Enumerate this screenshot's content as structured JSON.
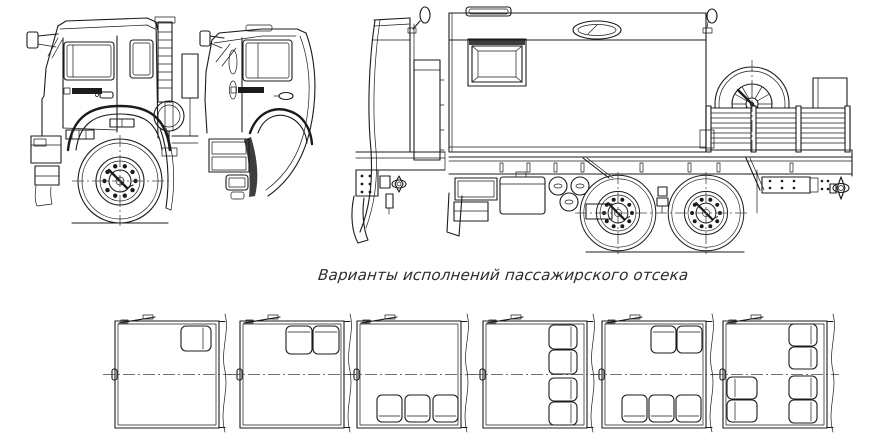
{
  "canvas": {
    "width": 883,
    "height": 442,
    "background": "#ffffff",
    "line_color": "#1b1b1b"
  },
  "caption": {
    "text": "Варианты исполнений пассажирского отсека"
  },
  "views": {
    "cab_side": "side view of cab with front wheel",
    "cab_door": "side view of cab door section",
    "cab_rear_fragment": "rear fragment of cab with frame and mudflap",
    "truck_side": "side view of truck with van body, spare wheel platform and tandem rear wheels"
  },
  "variants": [
    {
      "index": 1,
      "seats": 1,
      "layout": "one seat front-right"
    },
    {
      "index": 2,
      "seats": 2,
      "layout": "two seats front-right"
    },
    {
      "index": 3,
      "seats": 3,
      "layout": "three seats rear"
    },
    {
      "index": 4,
      "seats": 4,
      "layout": "four seats along right wall"
    },
    {
      "index": 5,
      "seats": 5,
      "layout": "two seats front-right and three seats rear"
    },
    {
      "index": 6,
      "seats": 6,
      "layout": "four seats along right wall and two seats left-rear"
    }
  ]
}
